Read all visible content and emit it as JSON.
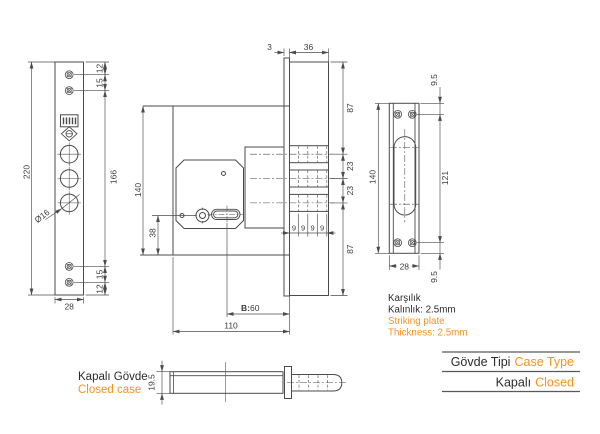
{
  "colors": {
    "line": "#4b4b4b",
    "text": "#3c3c3c",
    "accent": "#f6921e",
    "table_line": "#58595b"
  },
  "front_view": {
    "height": "220",
    "width": "28",
    "screw_top_offset": "12",
    "screw_top_gap": "15",
    "screw_span": "166",
    "screw_bot_gap": "15",
    "screw_bot_offset": "12",
    "bolt_hole_dia": "Ø16"
  },
  "side_view": {
    "faceplate_thickness": "3",
    "bolt_throw": "36",
    "top_to_bolt": "87",
    "bolt_pitch_1": "23",
    "bolt_pitch_2": "23",
    "bolt_to_bottom": "87",
    "throw_step_1": "9",
    "throw_step_2": "9",
    "throw_step_3": "9",
    "throw_step_4": "9",
    "body_height": "140",
    "key_center_height": "38",
    "backset_prefix": "B:",
    "backset_value": "60",
    "body_width": "110"
  },
  "strike_view": {
    "screw_top_offset": "9.5",
    "height": "140",
    "screw_span": "121",
    "screw_bot_offset": "9.5",
    "width": "28"
  },
  "bottom_view": {
    "thickness": "19.5",
    "caption_tr": "Kapalı Gövde",
    "caption_en": "Closed case"
  },
  "note": {
    "line1_tr": "Karşılık",
    "line2_tr": "Kalınlık: 2.5mm",
    "line1_en": "Striking plate",
    "line2_en": "Thickness: 2.5mm"
  },
  "spec_table": {
    "rows": [
      {
        "tr": "Gövde Tipi",
        "en": "Case Type"
      },
      {
        "tr": "Kapalı",
        "en": "Closed"
      }
    ]
  }
}
